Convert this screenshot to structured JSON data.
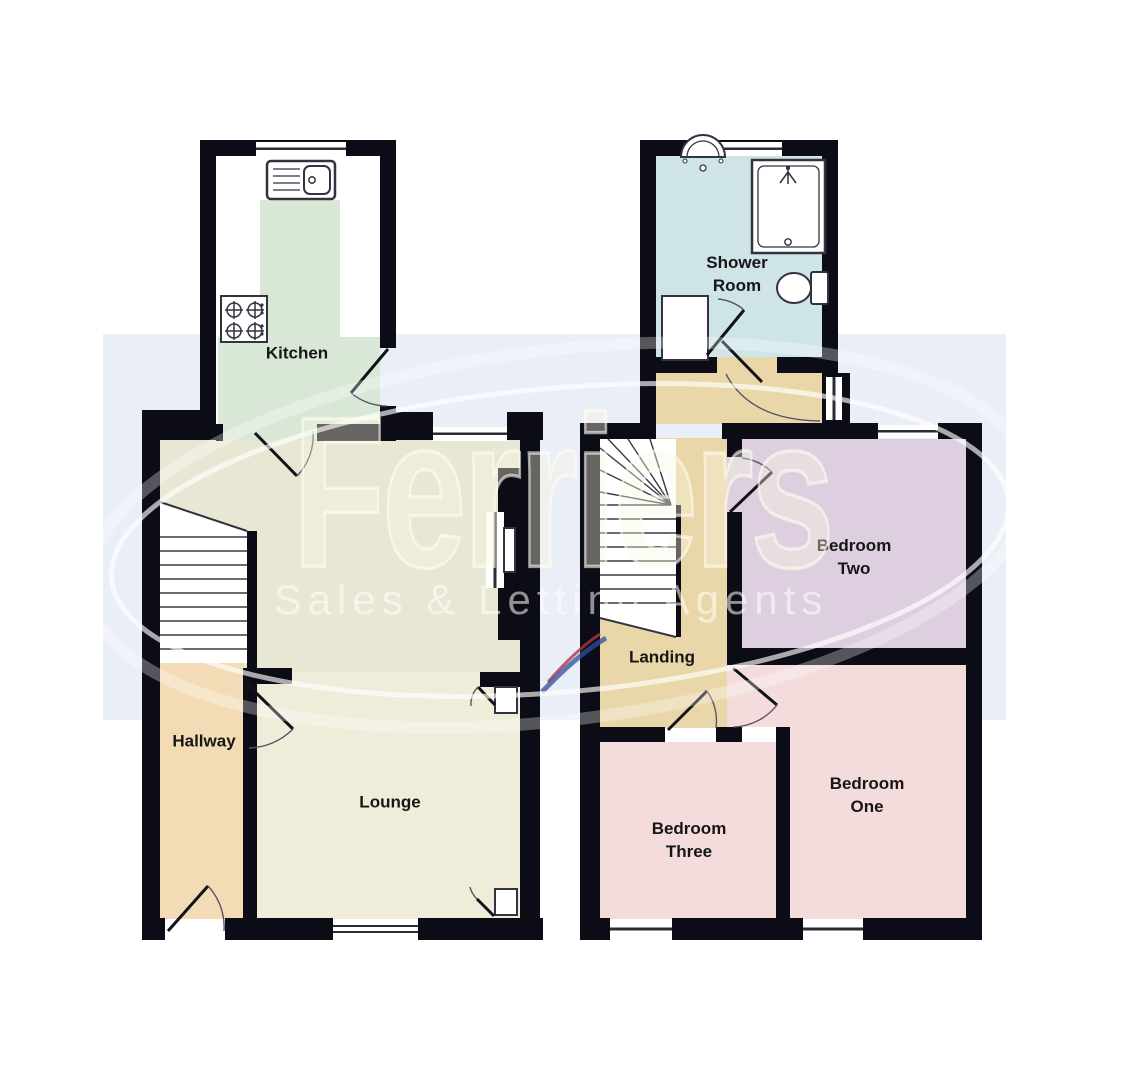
{
  "watermark": {
    "brand": "Ferriers",
    "tagline": "Sales & Letting Agents"
  },
  "floors": {
    "ground": {
      "name": "Ground Floor",
      "rooms": [
        {
          "id": "kitchen",
          "label": "Kitchen"
        },
        {
          "id": "dining-area",
          "label": ""
        },
        {
          "id": "hallway",
          "label": "Hallway"
        },
        {
          "id": "lounge",
          "label": "Lounge"
        }
      ]
    },
    "first": {
      "name": "First Floor",
      "rooms": [
        {
          "id": "shower-room",
          "label": "Shower Room"
        },
        {
          "id": "landing",
          "label": "Landing"
        },
        {
          "id": "bedroom-two",
          "label": "Bedroom Two"
        },
        {
          "id": "bedroom-one",
          "label": "Bedroom One"
        },
        {
          "id": "bedroom-three",
          "label": "Bedroom Three"
        }
      ]
    }
  },
  "labels": {
    "kitchen": "Kitchen",
    "hallway": "Hallway",
    "lounge": "Lounge",
    "shower_line1": "Shower",
    "shower_line2": "Room",
    "landing": "Landing",
    "bedroom_two_line1": "Bedroom",
    "bedroom_two_line2": "Two",
    "bedroom_one_line1": "Bedroom",
    "bedroom_one_line2": "One",
    "bedroom_three_line1": "Bedroom",
    "bedroom_three_line2": "Three"
  },
  "fixtures": [
    "sink-icon",
    "hob-icon",
    "basin-icon",
    "shower-tray-icon",
    "toilet-icon",
    "cupboard",
    "stairs",
    "door-arc",
    "window"
  ],
  "colors": {
    "page": "#ffffff",
    "band": "#eaeef7",
    "wall": "#0c0c16",
    "kitchen": "#d8e7d6",
    "dining": "#e8e7d4",
    "lounge": "#f0ecda",
    "hallway": "#f3dbb5",
    "landing": "#e9d7a9",
    "shower": "#cfe4e7",
    "bedroom-pink": "#f3dcdb",
    "bedroom-mauve": "#ddcfdf",
    "stairs": "#ffffff",
    "label-ink": "#161616",
    "window-line": "#2b2b33",
    "door-line": "#11111a",
    "arc-line": "#555566",
    "fixture-line": "#333340",
    "watermark-cream": "#faf6e2",
    "swoosh-red": "#b03345",
    "swoosh-blue": "#2f4f9e"
  }
}
